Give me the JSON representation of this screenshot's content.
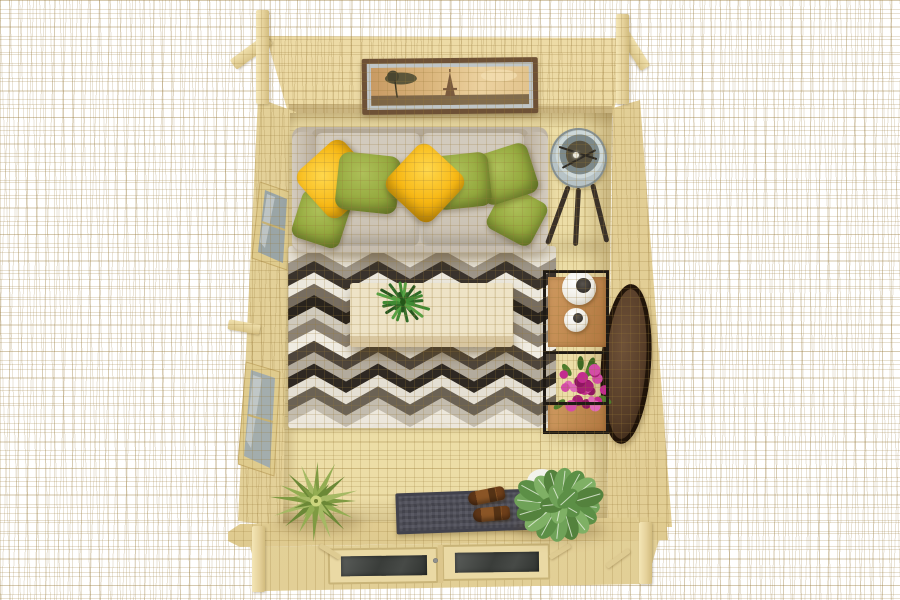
{
  "scene": {
    "description": "Top-down 3D render of a log cabin garden room interior",
    "background": "#ffffff",
    "wood": {
      "wall": "#e7d49c",
      "grain": "#c9ae6e",
      "floor": "#ecdda6",
      "beam": "#ecd9a6"
    },
    "objects": [
      "log-cabin-walls",
      "left-wall-windows",
      "picture-frame-eiffel-tower",
      "sofa",
      "throw-pillows",
      "chevron-rug",
      "coffee-table",
      "fern-centerpiece",
      "floor-lamp",
      "display-shelf",
      "white-vases",
      "round-mirror",
      "bougainvillea-bouquet",
      "doormat",
      "clog-shoes",
      "bromeliad-plant",
      "fittonia-plant",
      "double-glass-doors"
    ]
  },
  "sofa": {
    "body": "#c9c0b2",
    "cushion": "#d2cabd",
    "pillow_yellow": "#f7b713",
    "pillow_green": "#93a83d"
  },
  "rug": {
    "base": "#e9e4d9",
    "rows": [
      "#e8e3d7",
      "#9d9588",
      "#3a332c",
      "#ece8dd",
      "#776d60",
      "#29231d",
      "#cfc9bc",
      "#8c8274",
      "#f0ece2",
      "#4e453b",
      "#b3ab9d",
      "#2e2822",
      "#e4dfd3",
      "#6b6254",
      "#c3bcae",
      "#ece7dc"
    ]
  },
  "table": {
    "top": "#eee3c6",
    "edge": "#d8c6a0"
  },
  "lamp": {
    "shade": "#b7c3c6",
    "legs": "#3a3128"
  },
  "shelf": {
    "frame": "#1f1a14",
    "wood": "#c08a55",
    "vase": "#f1eee6",
    "mirror": "#553c27"
  },
  "flowers": {
    "petals": [
      "#c32b8f",
      "#d44ca6",
      "#a61d73",
      "#e06ab8",
      "#8f1660"
    ],
    "leaves": [
      "#4e7c2c",
      "#3f6823"
    ]
  },
  "plants": {
    "fern": {
      "colors": [
        "#2f6b28",
        "#3f8a33",
        "#55a344",
        "#27571f"
      ],
      "blades": 18
    },
    "bromeliad": {
      "colors": [
        "#7f9a42",
        "#93ad52",
        "#6b8836",
        "#a5b964"
      ],
      "blades": 16,
      "center": "#ccd57d"
    },
    "fittonia": {
      "leaf": [
        "#6fa258",
        "#5c8f46",
        "#7fb065",
        "#54823d"
      ],
      "vein": "#e8f0e0",
      "pot": "#f2f2ec"
    }
  },
  "mat": {
    "base": "#50505a",
    "border": "#42424c"
  },
  "doors": {
    "glass": "#3d403e",
    "frame": "#c9b478"
  },
  "picture": {
    "frame": "#6e5136",
    "mat": "#bfc5c7",
    "sky": [
      "#c89a63",
      "#dcb87f",
      "#ecd2a0",
      "#e2c38d"
    ],
    "subject": "eiffel-tower-landscape"
  }
}
